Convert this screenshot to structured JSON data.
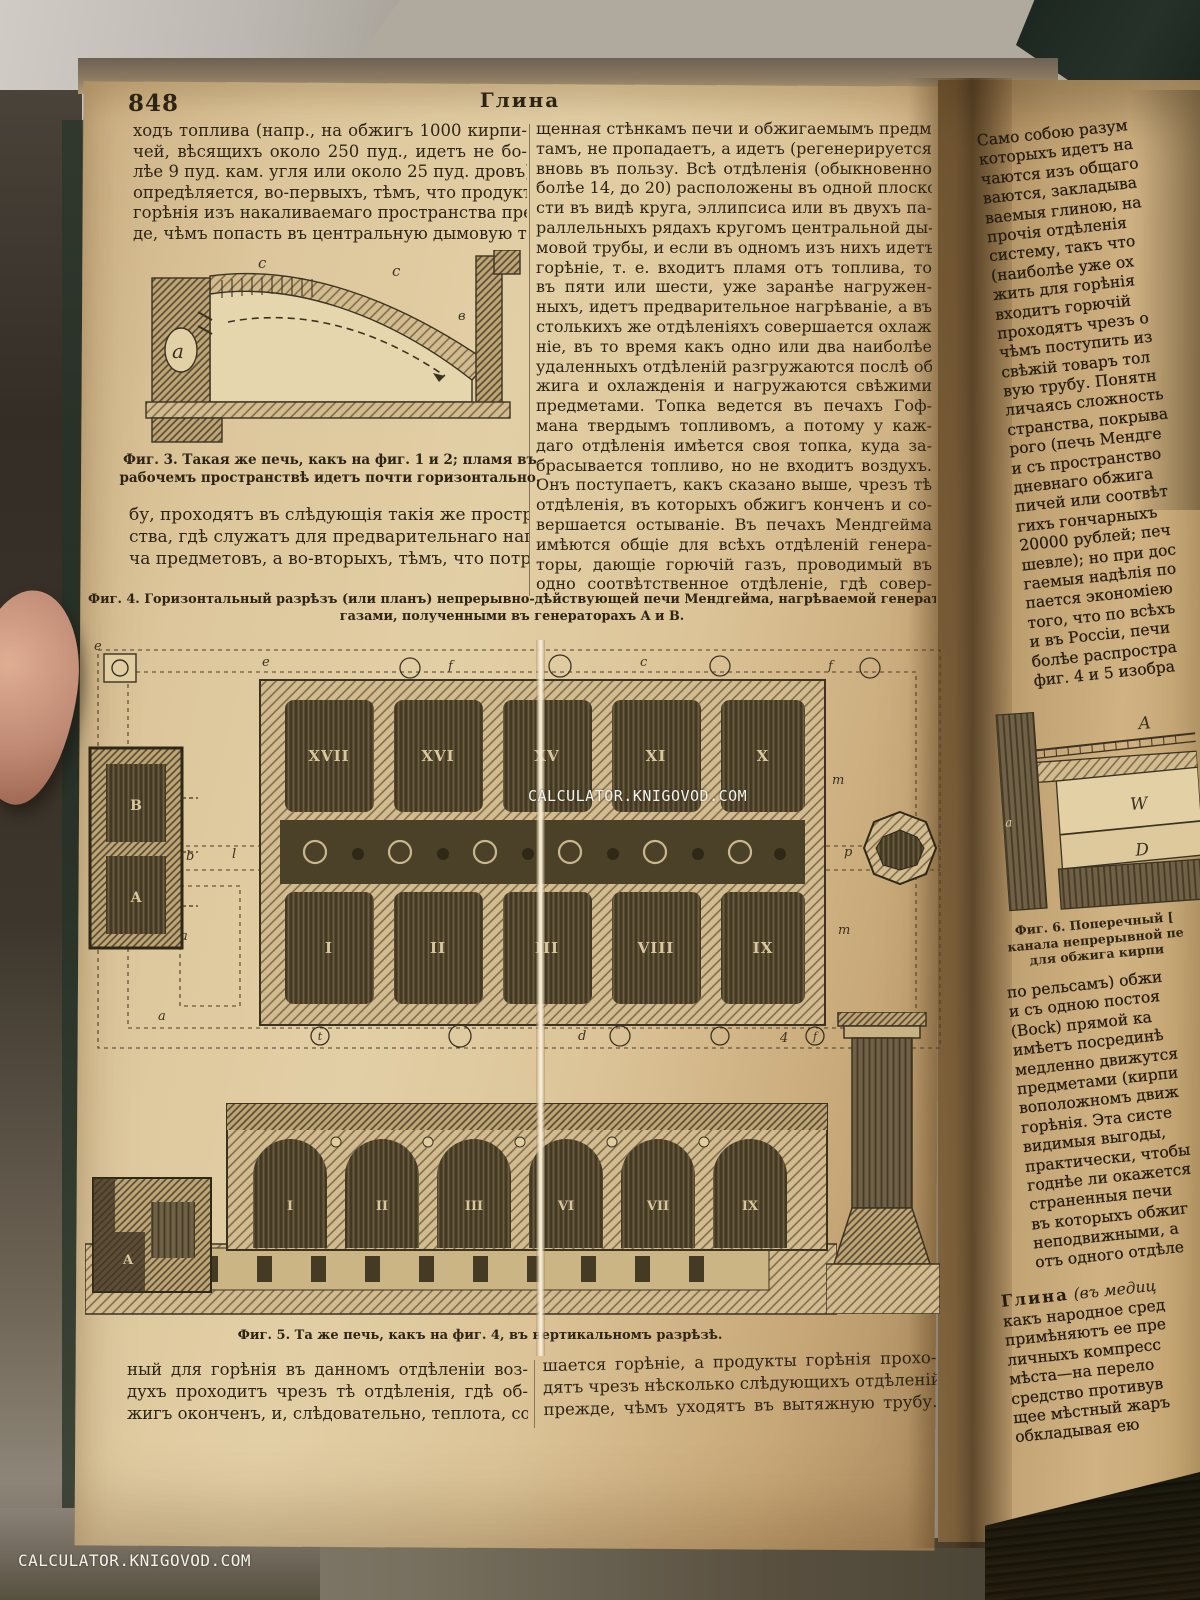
{
  "photo": {
    "watermark_center": "CALCULATOR.KNIGOVOD.COM",
    "watermark_corner": "CALCULATOR.KNIGOVOD.COM"
  },
  "page": {
    "number": "848",
    "header": "Глина"
  },
  "left_column": {
    "lines": [
      "ходъ топлива (напр., на обжигъ 1000 кирпи-",
      "чей, вѣсящихъ около 250 пуд., идетъ не бо-",
      "лѣе 9 пуд. кам. угля или около 25 пуд. дровъ)",
      "опредѣляется, во-первыхъ, тѣмъ, что продукты",
      "горѣнія изъ накаливаемаго пространства преж-",
      "де, чѣмъ попасть въ центральную дымовую тру-"
    ],
    "continued_lines": [
      "бу, проходятъ въ слѣдующія такія же простран-",
      "ства, гдѣ служатъ для предварительнаго нагрѣ-",
      "ча предметовъ, а во-вторыхъ, тѣмъ, что потреб-"
    ]
  },
  "middle_column": {
    "lines": [
      "щенная стѣнкамъ печи и обжигаемымъ предме-",
      "тамъ, не пропадаетъ, а идетъ (регенерируется)",
      "вновь въ пользу. Всѣ отдѣленія (обыкновенно",
      "болѣе 14, до 20) расположены въ одной плоско-",
      "сти въ видѣ круга, эллипсиса или въ двухъ па-",
      "раллельныхъ рядахъ кругомъ центральной ды-",
      "мовой трубы, и если въ одномъ изъ нихъ идетъ",
      "горѣніе, т. е. входитъ пламя отъ топлива, то",
      "въ пяти или шести, уже заранѣе нагружен-",
      "ныхъ, идетъ предварительное нагрѣваніе, а въ",
      "столькихъ же отдѣленіяхъ совершается охлажде-",
      "ніе, въ то время какъ одно или два наиболѣе",
      "удаленныхъ отдѣленій разгружаются послѣ об-",
      "жига и охлажденія и нагружаются свѣжими",
      "предметами. Топка ведется въ печахъ Гоф-",
      "мана твердымъ топливомъ, а потому у каж-",
      "даго отдѣленія имѣется своя топка, куда за-",
      "брасывается топливо, но не входитъ воздухъ.",
      "Онъ поступаетъ, какъ сказано выше, чрезъ тѣ",
      "отдѣленія, въ которыхъ обжигъ конченъ и со-",
      "вершается остываніе. Въ печахъ Мендгейма",
      "имѣются общіе для всѣхъ отдѣленій генера-",
      "торы, дающіе горючій газъ, проводимый въ",
      "одно соотвѣтственное отдѣленіе, гдѣ совер-"
    ]
  },
  "fig3": {
    "caption_lines": [
      "Фиг. 3.  Такая же печь,  какъ на фиг. 1 и 2;  пламя въ",
      "рабочемъ пространствѣ идетъ почти горизонтально."
    ],
    "labels": {
      "c_left": "c",
      "c_right": "c",
      "a": "a",
      "v": "в"
    }
  },
  "fig4": {
    "caption_lines": [
      "Фиг. 4.  Горизонтальный  разрѣзъ (или планъ) непрерывно-дѣйствующей печи Мендгейма,  нагрѣваемой генераторными",
      "газами, полученными въ генераторахъ A и B."
    ],
    "top_row_labels": [
      "XVII",
      "XVI",
      "XV",
      "XI",
      "X"
    ],
    "bottom_row_labels": [
      "I",
      "II",
      "III",
      "VIII",
      "IX"
    ],
    "generator_labels": {
      "top": "B",
      "bottom": "A"
    },
    "edge_labels": {
      "e1": "e",
      "e2": "e",
      "f1": "f",
      "c": "c",
      "f2": "f",
      "b": "b",
      "l": "l",
      "a_left": "a",
      "a_bottom": "a",
      "m1": "m",
      "m2": "m",
      "p": "p",
      "d": "d",
      "t": "t",
      "four": "4",
      "f3": "f"
    }
  },
  "fig5": {
    "caption": "Фиг. 5.  Та же печь,  какъ на фиг. 4,  въ вертикальномъ разрѣзѣ.",
    "arch_labels": [
      "I",
      "II",
      "III",
      "VI",
      "VII",
      "IX"
    ],
    "generator_label": "A"
  },
  "fig6": {
    "caption_lines": [
      "Фиг.  6.   Поперечный  [",
      "канала непрерывной пе",
      "для обжига кирпи"
    ],
    "labels": {
      "A": "A",
      "W": "W",
      "D": "D",
      "a": "a"
    }
  },
  "bottom_left_column": {
    "lines": [
      "ный для горѣнія въ данномъ отдѣленіи воз-",
      "духъ проходитъ чрезъ тѣ отдѣленія, гдѣ об-",
      "жигъ оконченъ, и, слѣдовательно, теплота, сооб-"
    ]
  },
  "bottom_middle_column": {
    "lines": [
      "шается горѣніе, а продукты горѣнія прохо-",
      "дятъ чрезъ нѣсколько слѣдующихъ отдѣленій",
      "прежде, чѣмъ уходятъ въ вытяжную трубу."
    ]
  },
  "right_page": {
    "top_lines": [
      "Само собою разум",
      "которыхъ идетъ на",
      "чаются изъ общаго",
      "ваются, закладыва",
      "ваемыя глиною, на",
      "прочія  отдѣленія",
      "систему, такъ что",
      "(наиболѣе уже ох",
      "жить для горѣнія",
      "входитъ горючій",
      "проходятъ чрезъ о",
      "чѣмъ поступить из",
      "свѣжій товаръ тол",
      "вую трубу. Понятн",
      "личаясь сложность",
      "странства, покрыва",
      "рого (печь Мендге",
      "и съ пространство",
      "дневнаго обжига",
      "пичей или соотвѣт",
      "гихъ гончарныхъ",
      "20000 рублей; печ",
      "шевле); но при дос",
      "гаемыя надѣлія по",
      "пается экономіею",
      "того, что по всѣхъ",
      "и въ Россіи, печи",
      "болѣе  распростра",
      "фиг. 4 и 5 изобра"
    ],
    "mid_lines": [
      "по рельсамъ) обжи",
      "и съ одною постоя",
      "(Bock) прямой ка",
      "имѣетъ посрединѣ",
      "медленно движутся",
      "предметами (кирпи",
      "воположномъ движ",
      "горѣнія. Эта систе",
      "видимыя выгоды,",
      "практически, чтобы",
      "годнѣе ли окажется",
      "страненныя печи",
      "въ которыхъ обжиг",
      "неподвижными, а",
      "отъ одного отдѣле"
    ],
    "entry": {
      "term": "Глина",
      "qualifier": " (въ медиц",
      "lines": [
        "какъ народное сред",
        "примѣняютъ ее пре",
        "личныхъ компресс",
        "мѣста—на перело",
        "средство противув",
        "щее мѣстный жаръ",
        "обкладывая ею"
      ]
    }
  }
}
